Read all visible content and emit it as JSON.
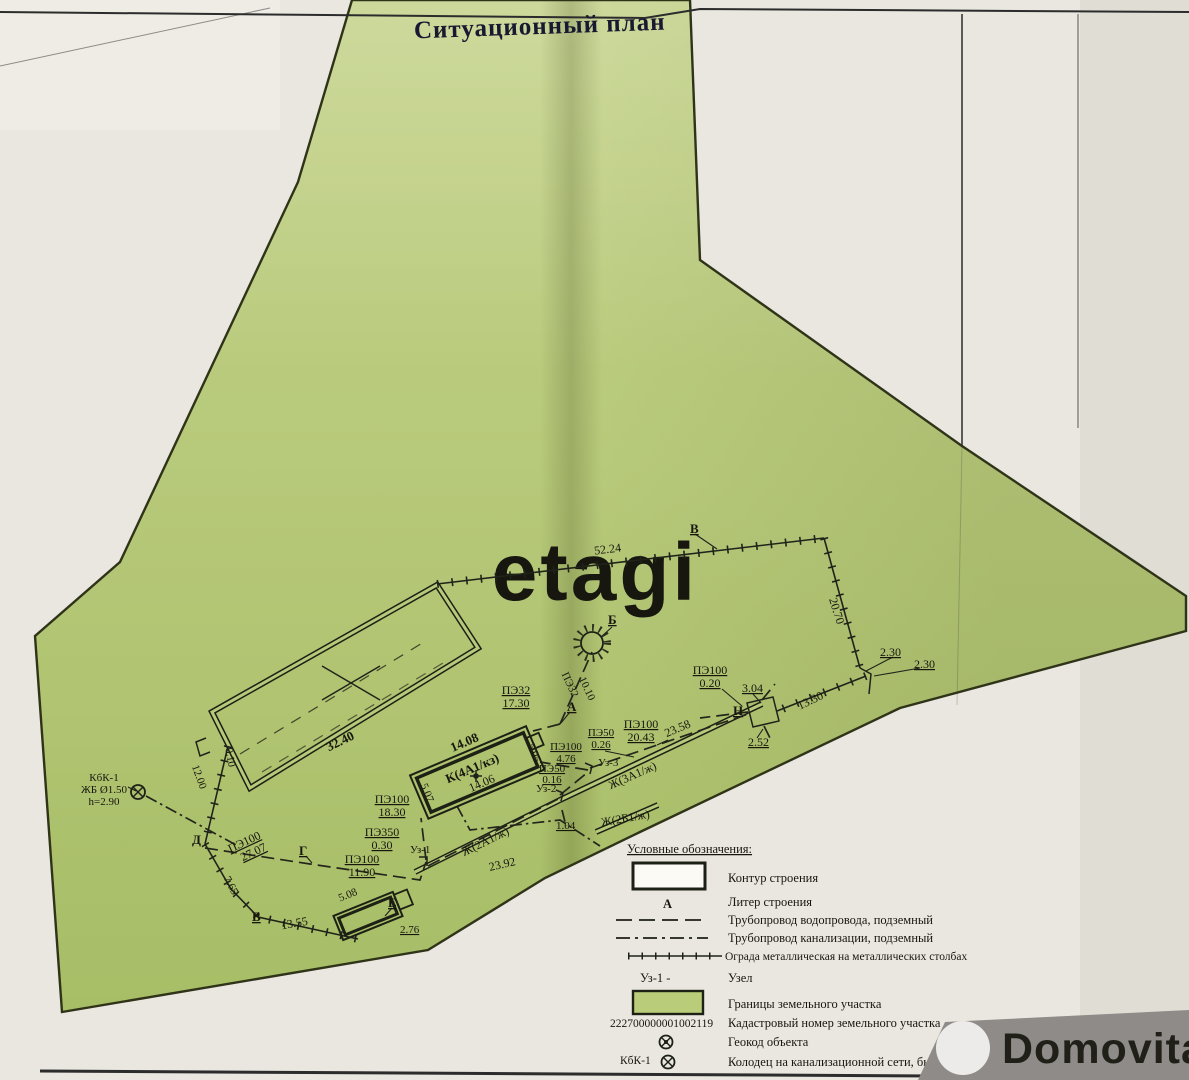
{
  "title": "Ситуационный план",
  "watermark": {
    "etagi": "etagi",
    "domovita": "Domovita"
  },
  "plan": {
    "points": {
      "v_top": "В",
      "b": "Б",
      "a": "А",
      "g": "Г",
      "d": "Д",
      "v_low": "В",
      "e": "Е",
      "n": "Н"
    },
    "nodes": {
      "uz1": "Уз-1",
      "uz2": "Уз-2",
      "uz3": "Уз-3"
    },
    "well": {
      "name": "КбК-1",
      "spec": "ЖБ Ø1.50",
      "depth": "h=2.90"
    },
    "building_k": {
      "name": "К(4А1/кз)",
      "top": "14.08",
      "bottom": "14.06",
      "right": "5.05",
      "left": "5.07"
    },
    "building_rows": {
      "row_a": "Ж(2А1/ж)",
      "row_b": "Ж(3А1/ж)",
      "row_c": "Ж(2Б1/ж)"
    },
    "shed": {
      "length": "32.40",
      "side": "0.10"
    },
    "dims": {
      "d52_24": "52.24",
      "d20_70": "20.70",
      "d2_30a": "2.30",
      "d2_30b": "2.30",
      "d3_04": "3.04",
      "d13_30": "13.30",
      "d2_52": "2.52",
      "d23_58": "23.58",
      "d23_92": "23.92",
      "d13_55": "13.55",
      "d7_65": "7.65",
      "d12_00": "12.00",
      "d1_04": "1.04",
      "d5_08": "5.08",
      "d2_76": "2.76"
    },
    "pipes": {
      "p020": {
        "t": "ПЭ100",
        "v": "0.20"
      },
      "p2043": {
        "t": "ПЭ100",
        "v": "20.43"
      },
      "p026": {
        "t": "ПЭ50",
        "v": "0.26"
      },
      "p476": {
        "t": "ПЭ100",
        "v": "4.76"
      },
      "p016": {
        "t": "ПЭ50",
        "v": "0.16"
      },
      "p1830": {
        "t": "ПЭ100",
        "v": "18.30"
      },
      "p030": {
        "t": "ПЭ350",
        "v": "0.30"
      },
      "p1190": {
        "t": "ПЭ100",
        "v": "11.90"
      },
      "p2707": {
        "t": "ПЭ100",
        "v": "27.07"
      },
      "p1730": {
        "t": "ПЭ32",
        "v": "17.30"
      },
      "p1010": {
        "t": "ПЭ32",
        "v": "10.10"
      }
    }
  },
  "legend": {
    "heading": "Условные обозначения:",
    "letter_symbol": "А",
    "uzel_symbol": "Уз-1 -",
    "kbk_symbol": "КбК-1",
    "cadastral_number": "222700000001002119",
    "items": [
      {
        "label": "Контур строения"
      },
      {
        "label": "Литер строения"
      },
      {
        "label": "Трубопровод водопровода, подземный"
      },
      {
        "label": "Трубопровод канализации, подземный"
      },
      {
        "label": "Ограда металлическая на металлических столбах"
      },
      {
        "label": "Узел"
      },
      {
        "label": "Границы земельного участка"
      },
      {
        "label": "Кадастровый номер земельного участка"
      },
      {
        "label": "Геокод объекта"
      },
      {
        "label": "Колодец на канализационной сети, бытовой"
      }
    ]
  },
  "colors": {
    "parcel": "#b7c97a",
    "paper": "#eae7e0",
    "ink": "#1d1d1d",
    "photo_bg": "#8e8b88"
  }
}
